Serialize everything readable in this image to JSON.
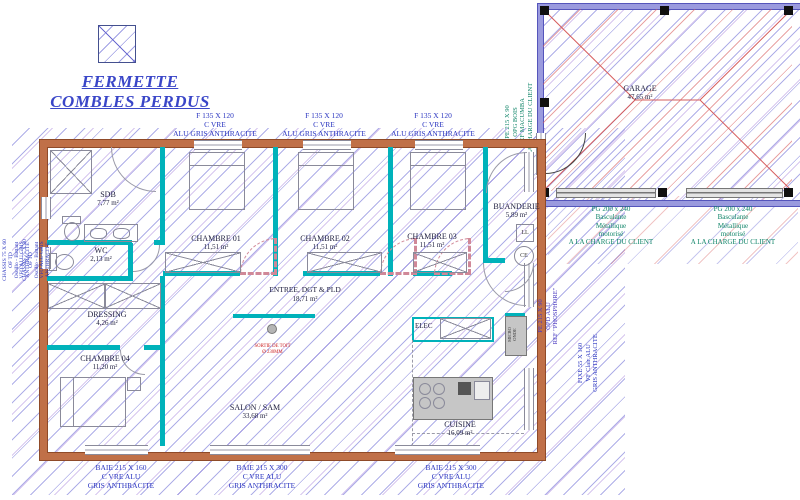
{
  "title": {
    "line1": "FERMETTE",
    "line2": "COMBLES PERDUS"
  },
  "rooms": {
    "sdb": {
      "name": "SDB",
      "area": "7,77 m²"
    },
    "wc": {
      "name": "WC",
      "area": "2,13 m²"
    },
    "dressing": {
      "name": "DRESSING",
      "area": "4,26 m²"
    },
    "chambre01": {
      "name": "CHAMBRE 01",
      "area": "11,51 m²"
    },
    "chambre02": {
      "name": "CHAMBRE 02",
      "area": "11,51 m²"
    },
    "chambre03": {
      "name": "CHAMBRE 03",
      "area": "11,51 m²"
    },
    "chambre04": {
      "name": "CHAMBRE 04",
      "area": "11,20 m²"
    },
    "buanderie": {
      "name": "BUANDERIE",
      "area": "5,89 m²"
    },
    "entree": {
      "name": "ENTREE, DGT & PLD",
      "area": "18,71 m²"
    },
    "salon": {
      "name": "SALON / SAM",
      "area": "33,68 m²"
    },
    "cuisine": {
      "name": "CUISINE",
      "area": "16,09 m²"
    },
    "garage": {
      "name": "GARAGE",
      "area": "47,65 m²"
    },
    "elec": {
      "name": "ELEC"
    }
  },
  "top_windows": [
    {
      "l1": "F 135 X 120",
      "l2": "C VRE",
      "l3": "ALU GRIS ANTHRACITE"
    },
    {
      "l1": "F 135 X 120",
      "l2": "C VRE",
      "l3": "ALU GRIS ANTHRACITE"
    },
    {
      "l1": "F 135 X 120",
      "l2": "C VRE",
      "l3": "ALU GRIS ANTHRACITE"
    }
  ],
  "bottom_windows": [
    {
      "l1": "BAIE 215 X 160",
      "l2": "C VRE ALU",
      "l3": "GRIS ANTHRACITE"
    },
    {
      "l1": "BAIE 215 X 300",
      "l2": "C VRE ALU",
      "l3": "GRIS ANTHRACITE"
    },
    {
      "l1": "BAIE 215 X 300",
      "l2": "C VRE ALU",
      "l3": "GRIS ANTHRACITE"
    }
  ],
  "left_windows": [
    {
      "l1": "CHASSIS 75 X 60",
      "l2": "OF TD",
      "l3": "Oscillo - Battant",
      "l4": "VFO ALU GRIS",
      "l5": "ANTHRACITE"
    },
    {
      "l1": "CHASSIS 75 X 80",
      "l2": "OF TD",
      "l3": "Oscillo - Battant",
      "l4": "VFO ALU GRIS",
      "l5": "ANTHRACITE"
    }
  ],
  "right_labels": {
    "garage_entry": {
      "l1": "PE 215 X 90",
      "l2": "OPG BOIS",
      "l3": "REF MACUMBA",
      "l4": "A LA CHARGE DU CLIENT"
    },
    "house_entry": {
      "l1": "PE 215 X 90",
      "l2": "OPD ALU",
      "l3": "REF \"PHOSPHORE\""
    },
    "fixed_window": {
      "l1": "FIXE 55 X 160",
      "l2": "VF Clair ALU",
      "l3": "GRIS ANTHRACITE"
    }
  },
  "garage_door_labels": [
    {
      "l1": "PG 200 x 240",
      "l2": "Basculante",
      "l3": "Métallique",
      "l4": "motorisé",
      "l5": "A LA CHARGE DU CLIENT"
    },
    {
      "l1": "PG 200 x 240",
      "l2": "Basculante",
      "l3": "Métallique",
      "l4": "motorisé",
      "l5": "A LA CHARGE DU CLIENT"
    }
  ],
  "equipment": {
    "washing_machine": "LL",
    "water_heater": "CE",
    "appliance_l1": "MICRO",
    "appliance_l2": "ONDE"
  },
  "roof_outlet": {
    "l1": "SORTIE DE TOIT",
    "l2": "Ø 230MM"
  },
  "colors": {
    "wall": "#c07048",
    "partition": "#00b2ba",
    "hatch": "#5f5fd2",
    "roof": "#d65c5c",
    "text_blue": "#2a35c0",
    "text_green": "#0f8468",
    "text_red": "#cc2222",
    "title": "#3a46c8"
  }
}
